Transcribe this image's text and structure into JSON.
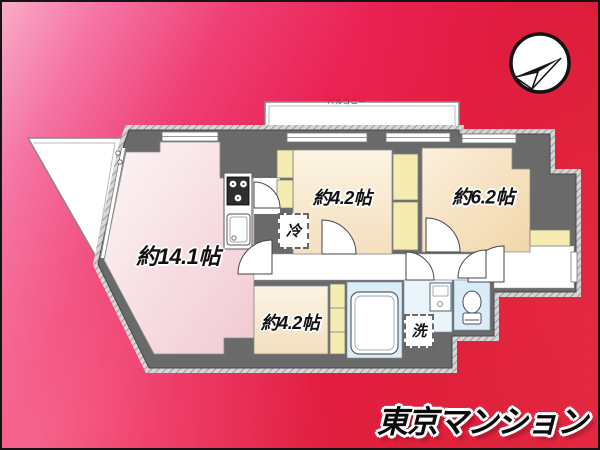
{
  "rooms": {
    "ldk": {
      "label": "約14.1帖"
    },
    "bedroom_top": {
      "label": "約4.2帖"
    },
    "bedroom_right": {
      "label": "約6.2帖"
    },
    "bedroom_lower": {
      "label": "約4.2帖"
    }
  },
  "fixtures": {
    "refrigerator": {
      "label": "冷"
    },
    "washer": {
      "label": "洗"
    }
  },
  "balcony": {
    "label": "バルコニー"
  },
  "logo": {
    "text": "東京マンション"
  },
  "colors": {
    "background_top_left": "#f9abc7",
    "background_mid": "#ea2254",
    "background_bottom_right": "#ec3049",
    "wall": "#6a6a6a",
    "closet": "#f5ecb2",
    "water_area": "#d9ecf7",
    "room_pink": "#f3ced5",
    "room_cream": "#f5dfc0",
    "room_peach": "#f2d8ab",
    "logo_text": "#0b0b0b"
  }
}
